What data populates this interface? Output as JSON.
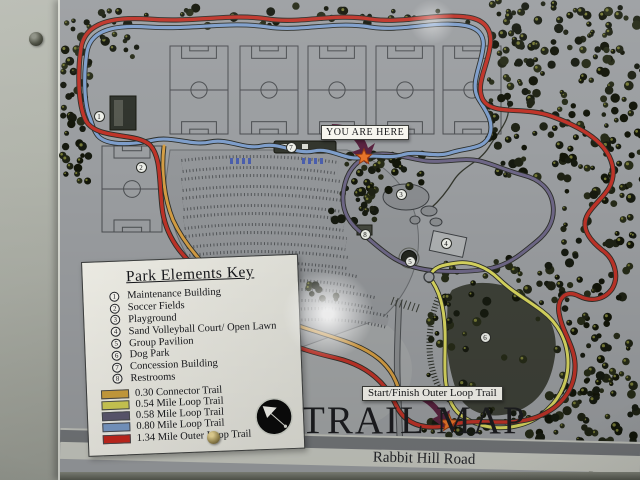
{
  "sign": {
    "title": "TRAIL MAP",
    "you_are_here": "YOU ARE HERE",
    "start_finish": "Start/Finish Outer Loop Trail",
    "road": "Rabbit Hill Road"
  },
  "legend": {
    "title": "Park Elements Key",
    "elements": [
      {
        "number": "1",
        "label": "Maintenance Building"
      },
      {
        "number": "2",
        "label": "Soccer Fields"
      },
      {
        "number": "3",
        "label": "Playground"
      },
      {
        "number": "4",
        "label": "Sand Volleyball Court/ Open Lawn"
      },
      {
        "number": "5",
        "label": "Group Pavilion"
      },
      {
        "number": "6",
        "label": "Dog Park"
      },
      {
        "number": "7",
        "label": "Concession Building"
      },
      {
        "number": "8",
        "label": "Restrooms"
      }
    ],
    "trails": [
      {
        "label": "0.30 Connector Trail",
        "color": "#cfa23f"
      },
      {
        "label": "0.54 Mile Loop Trail",
        "color": "#d3cf55"
      },
      {
        "label": "0.58 Mile Loop Trail",
        "color": "#5e5a72"
      },
      {
        "label": "0.80 Mile Loop Trail",
        "color": "#7b9cc9"
      },
      {
        "label": "1.34 Mile Outer Loop Trail",
        "color": "#c8281e"
      }
    ],
    "compass": "north-arrow"
  },
  "markers": [
    {
      "number": "1",
      "label": "Maintenance Building",
      "x": 97,
      "y": 116
    },
    {
      "number": "2",
      "label": "Soccer Fields",
      "x": 139,
      "y": 167
    },
    {
      "number": "3",
      "label": "Playground",
      "x": 399,
      "y": 194
    },
    {
      "number": "4",
      "label": "Sand Volleyball Court/ Open Lawn",
      "x": 444,
      "y": 243
    },
    {
      "number": "5",
      "label": "Group Pavilion",
      "x": 408,
      "y": 261
    },
    {
      "number": "6",
      "label": "Dog Park",
      "x": 483,
      "y": 337
    },
    {
      "number": "7",
      "label": "Concession Building",
      "x": 289,
      "y": 147
    },
    {
      "number": "8",
      "label": "Restrooms",
      "x": 363,
      "y": 234
    }
  ],
  "trail_colors": {
    "outer_loop": "#bf3328",
    "loop_080": "#7e9ecb",
    "loop_058": "#6e6787",
    "loop_054": "#d9d75f",
    "connector": "#d59e44"
  }
}
